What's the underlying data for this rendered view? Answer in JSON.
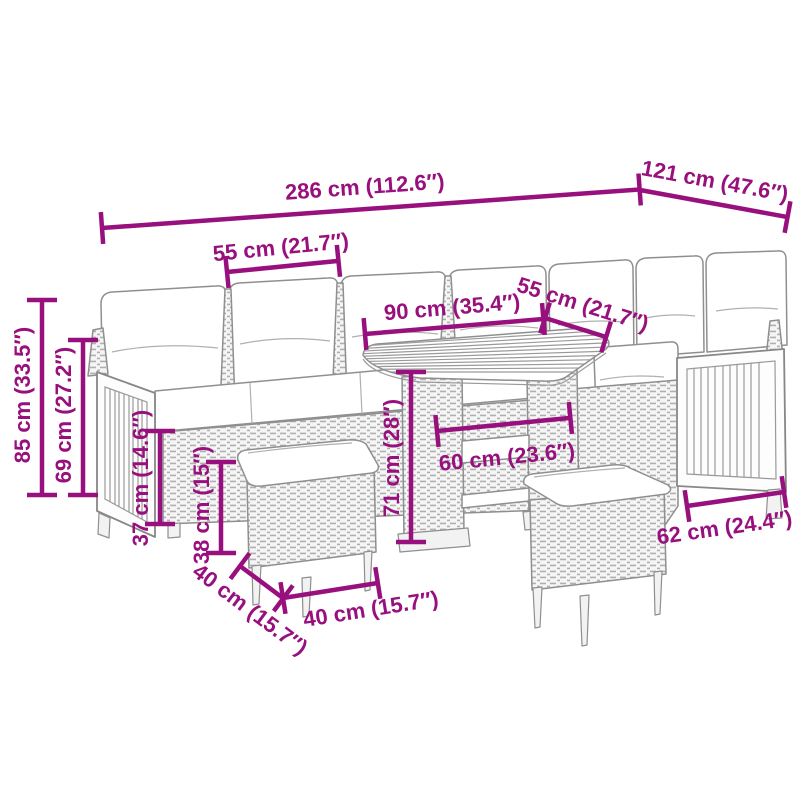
{
  "diagram": {
    "type": "product-dimension-diagram",
    "subject": "rattan-corner-sofa-set-with-table-and-stools",
    "background": "#ffffff",
    "colors": {
      "accent": "#98107d",
      "line": "#8f8f8f"
    },
    "dimensions": [
      {
        "id": "total-length",
        "label": "286 cm (112.6″)"
      },
      {
        "id": "side-length",
        "label": "121 cm (47.6″)"
      },
      {
        "id": "seat-width",
        "label": "55 cm (21.7″)"
      },
      {
        "id": "table-length",
        "label": "90 cm (35.4″)"
      },
      {
        "id": "seat-depth",
        "label": "55 cm (21.7″)"
      },
      {
        "id": "total-height",
        "label": "85 cm (33.5″)"
      },
      {
        "id": "armrest-height",
        "label": "69 cm (27.2″)"
      },
      {
        "id": "seat-height",
        "label": "37 cm (14.6″)"
      },
      {
        "id": "stool-height",
        "label": "38 cm (15″)"
      },
      {
        "id": "table-height",
        "label": "71 cm (28″)"
      },
      {
        "id": "table-width",
        "label": "60 cm (23.6″)"
      },
      {
        "id": "stool-depth",
        "label": "40 cm (15.7″)"
      },
      {
        "id": "stool-width",
        "label": "40 cm (15.7″)"
      },
      {
        "id": "side-depth",
        "label": "62 cm (24.4″)"
      }
    ]
  }
}
